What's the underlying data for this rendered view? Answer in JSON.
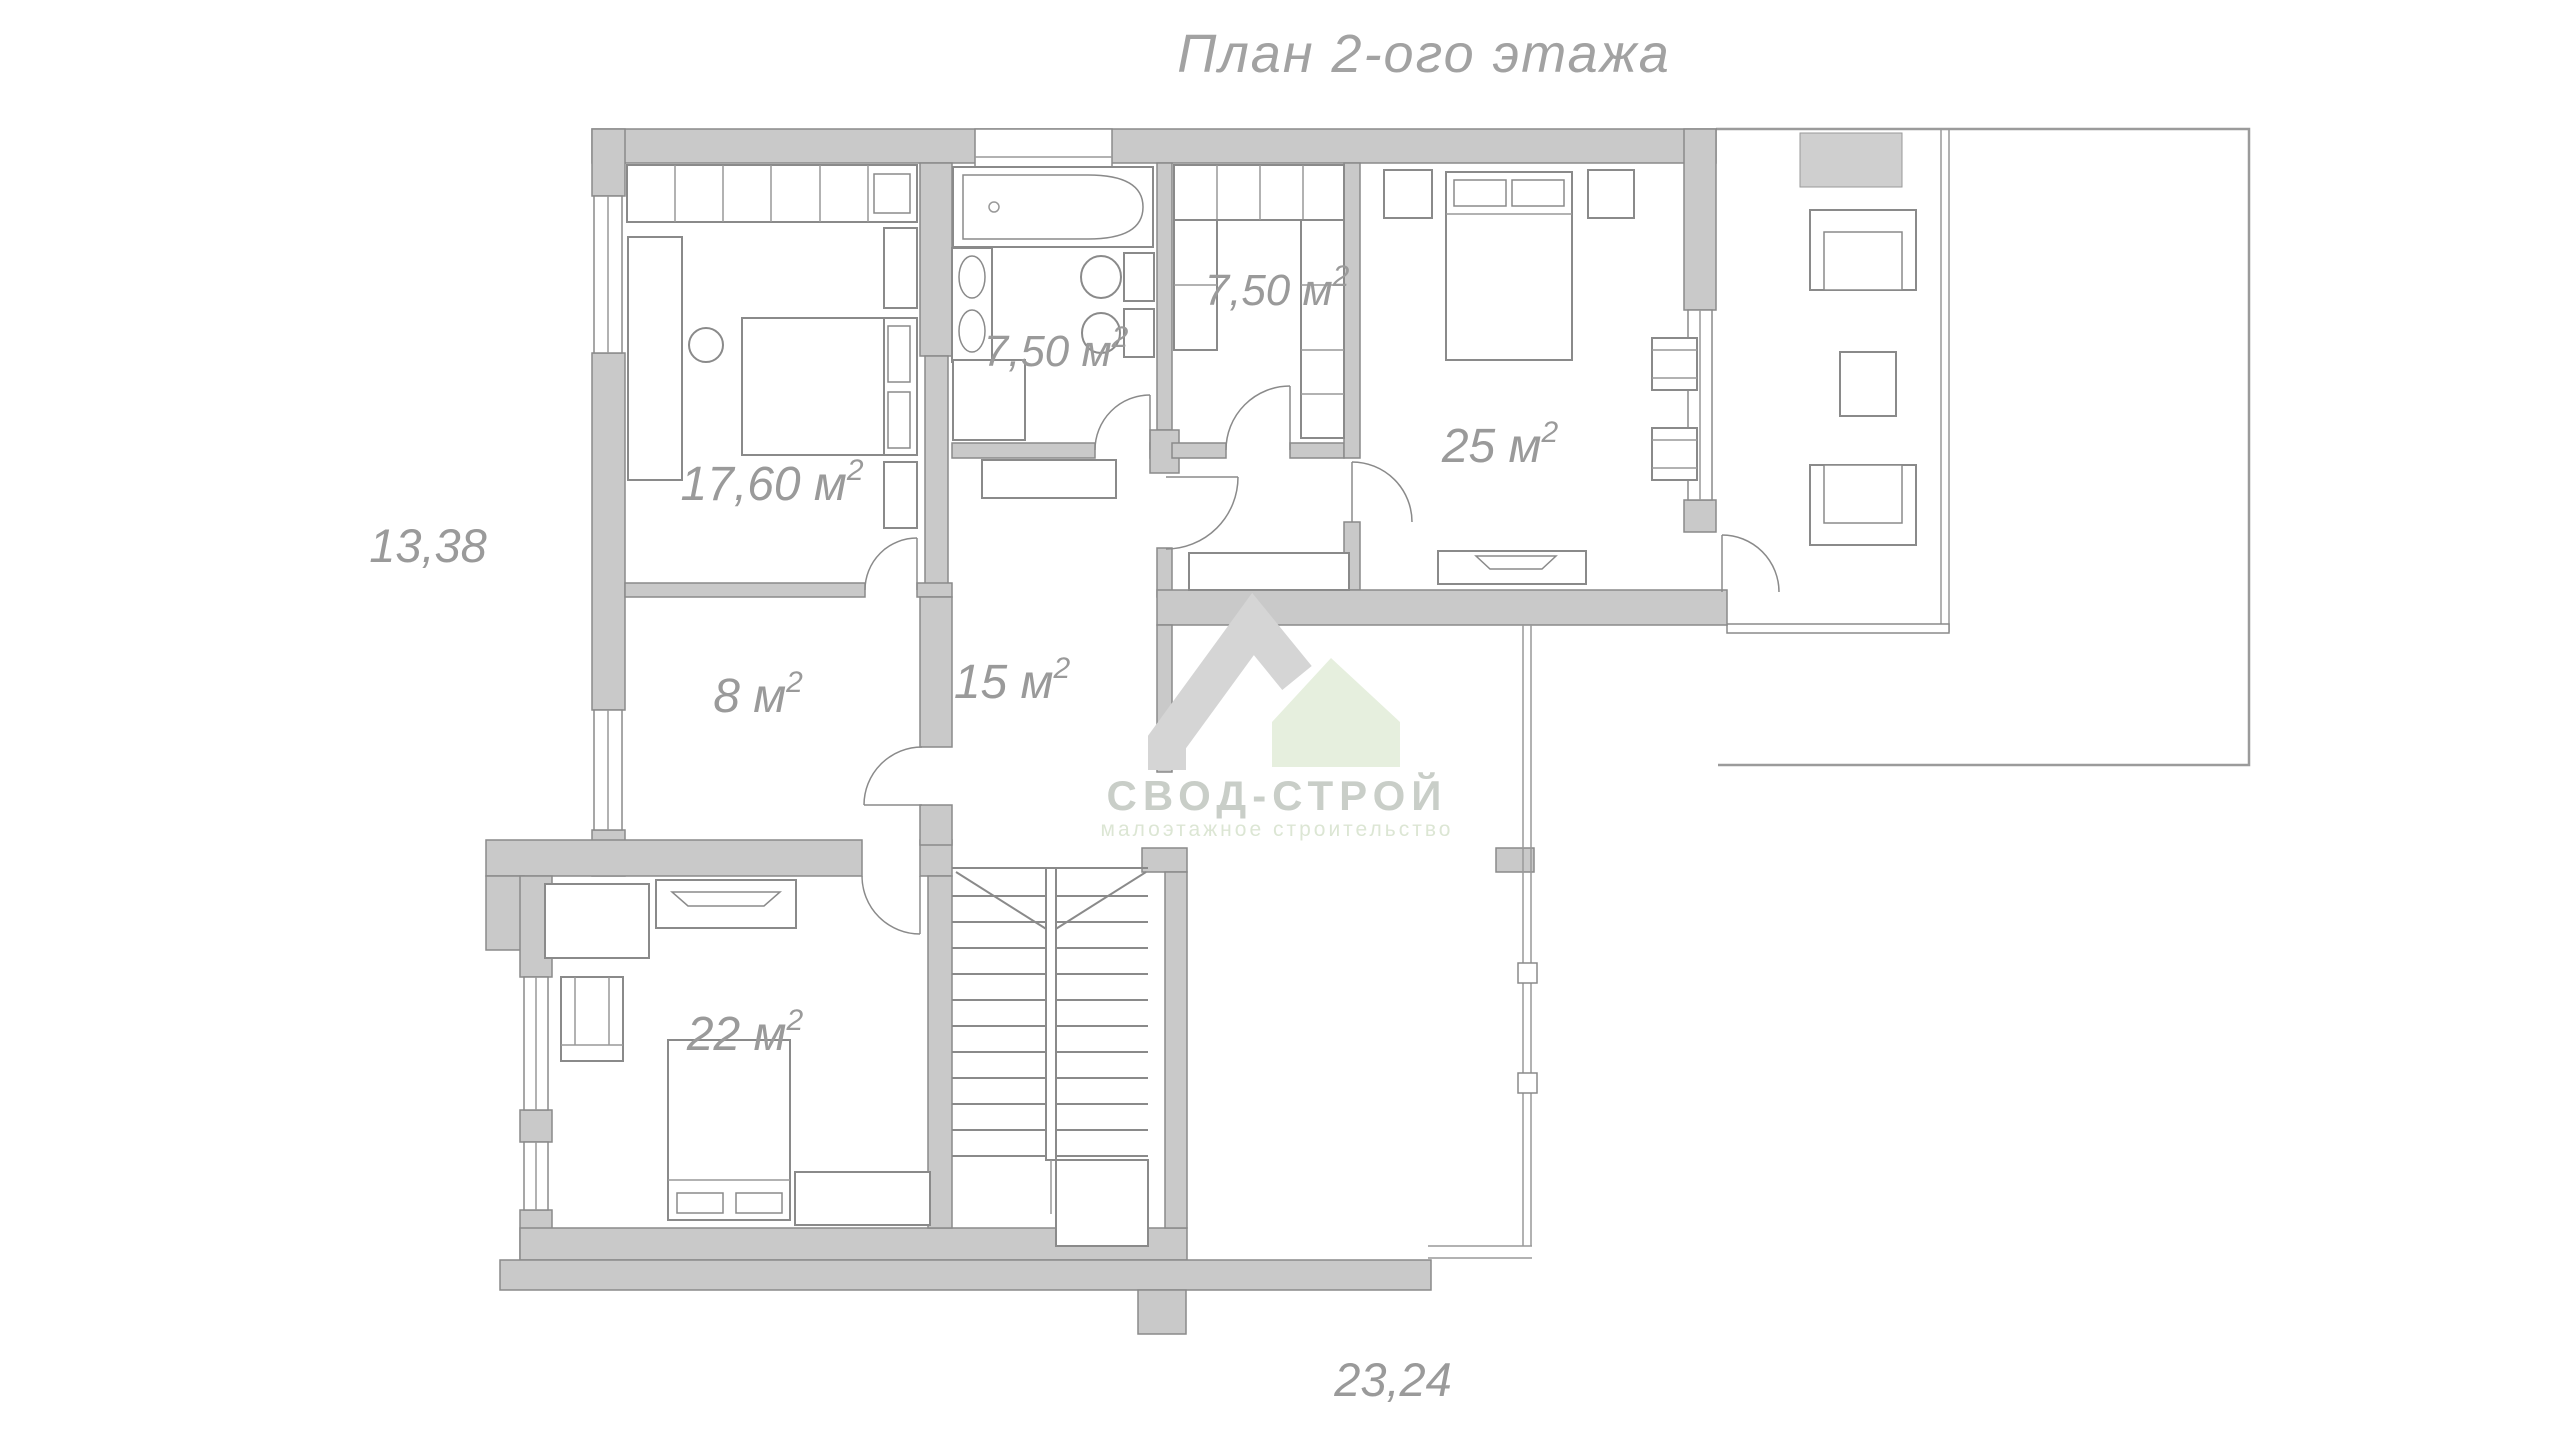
{
  "title": "План 2-ого этажа",
  "dimensions": {
    "left": "13,38",
    "bottom": "23,24"
  },
  "rooms": [
    {
      "id": "bedroom-1",
      "area": "17,60 м",
      "sup": "2"
    },
    {
      "id": "bathroom",
      "area": "7,50 м",
      "sup": "2"
    },
    {
      "id": "wardrobe",
      "area": "7,50 м",
      "sup": "2"
    },
    {
      "id": "bedroom-2",
      "area": "25 м",
      "sup": "2"
    },
    {
      "id": "storage",
      "area": "8 м",
      "sup": "2"
    },
    {
      "id": "hall",
      "area": "15 м",
      "sup": "2"
    },
    {
      "id": "bedroom-3",
      "area": "22 м",
      "sup": "2"
    }
  ],
  "watermark": {
    "name": "СВОД-СТРОЙ",
    "tagline": "малоэтажное строительство"
  },
  "colors": {
    "wall_fill": "#c9c9c9",
    "line": "#8a8a8a",
    "label": "#9a9a9a",
    "watermark_gray": "#d5d5d5",
    "watermark_green": "#e6efde",
    "watermark_text": "#c9cec8",
    "watermark_tagline": "#dce6d4"
  }
}
